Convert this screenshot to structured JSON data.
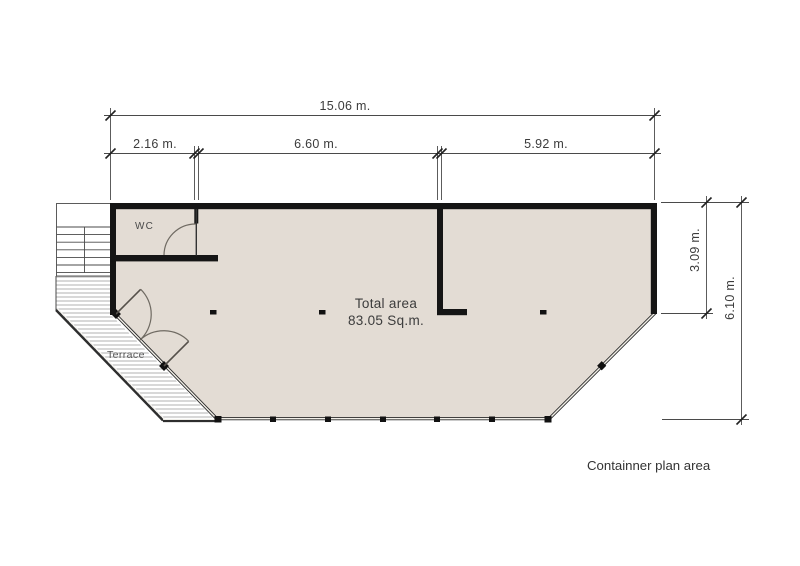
{
  "caption": "Containner plan area",
  "plan": {
    "dimensions": {
      "total_width": "15.06 m.",
      "segment_left": "2.16 m.",
      "segment_middle": "6.60 m.",
      "segment_right": "5.92 m.",
      "right_upper": "3.09 m.",
      "right_total": "6.10 m."
    },
    "labels": {
      "wc": "WC",
      "terrace": "Terrace"
    },
    "area": {
      "title": "Total area",
      "value": "83.05 Sq.m."
    }
  },
  "colors": {
    "background": "#ffffff",
    "floor_fill": "#e3dcd4",
    "wall": "#151515",
    "thin_line": "#3c3c3c",
    "hatch_line": "#a8a8a8",
    "door_arc": "#6f6a62"
  }
}
